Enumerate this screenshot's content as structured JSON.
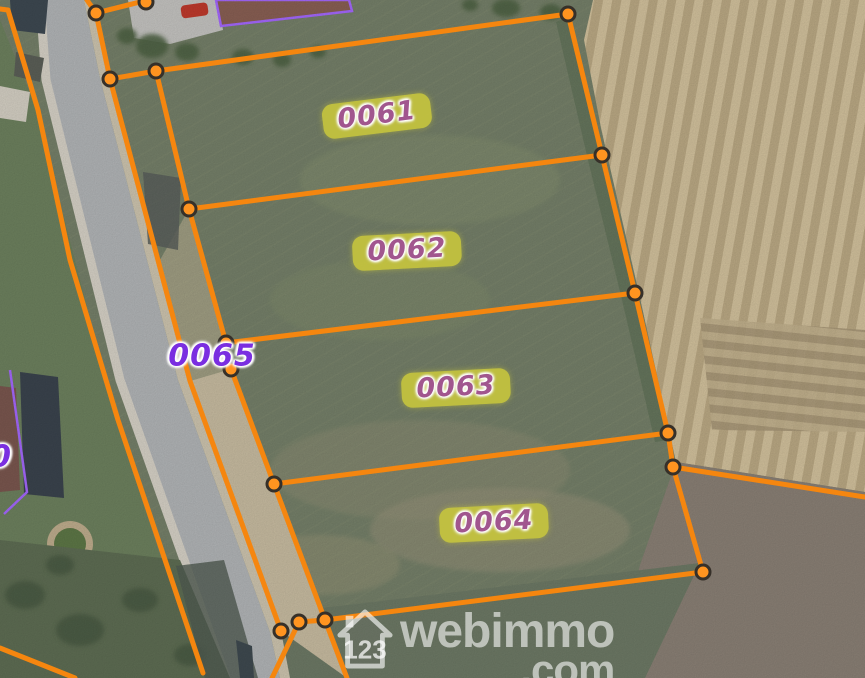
{
  "map": {
    "description": "Aerial cadastral map with orange parcel boundaries over a satellite photo",
    "watermark": {
      "icon_text": "123",
      "brand": "webimmo",
      "suffix": ".com"
    },
    "parcel_labels": {
      "badged": [
        {
          "id": "0061",
          "x": 377,
          "y": 116,
          "rot": -7
        },
        {
          "id": "0062",
          "x": 407,
          "y": 251,
          "rot": -3
        },
        {
          "id": "0063",
          "x": 456,
          "y": 388,
          "rot": -3
        },
        {
          "id": "0064",
          "x": 494,
          "y": 523,
          "rot": -3
        }
      ],
      "plain": [
        {
          "id": "0065",
          "x": 212,
          "y": 356,
          "rot": 0
        },
        {
          "id": "0",
          "x": 1,
          "y": 457,
          "rot": 0
        }
      ]
    },
    "overlay": {
      "line_color": "#f5860f",
      "vertex_fill": "#ff9420",
      "vertex_ring": "#363029",
      "badge_bg": "#c5c43e",
      "badge_text_color": "#a1568e",
      "plain_text_color": "#7a2ee0",
      "building_outline_color": "#a568ff",
      "lines": [
        {
          "name": "north-cross-a",
          "points": [
            [
              87,
              0
            ],
            [
              96,
              13
            ]
          ]
        },
        {
          "name": "north-cross-b",
          "points": [
            [
              96,
              13
            ],
            [
              148,
              0
            ]
          ]
        },
        {
          "name": "roadside-outer",
          "points": [
            [
              96,
              13
            ],
            [
              110,
              79
            ],
            [
              190,
              381
            ],
            [
              281,
              631
            ]
          ]
        },
        {
          "name": "strip-north-edge",
          "points": [
            [
              110,
              79
            ],
            [
              156,
              71
            ]
          ]
        },
        {
          "name": "parcels-west-edge",
          "points": [
            [
              156,
              71
            ],
            [
              189,
              209
            ],
            [
              226,
              343
            ],
            [
              231,
              369
            ],
            [
              274,
              484
            ],
            [
              325,
              620
            ],
            [
              347,
              678
            ]
          ]
        },
        {
          "name": "parcels-north-edge",
          "points": [
            [
              156,
              71
            ],
            [
              568,
              14
            ]
          ]
        },
        {
          "name": "parcels-east-edge",
          "points": [
            [
              568,
              14
            ],
            [
              602,
              155
            ],
            [
              635,
              293
            ],
            [
              668,
              433
            ],
            [
              673,
              467
            ],
            [
              703,
              572
            ]
          ]
        },
        {
          "name": "div-0061-0062",
          "points": [
            [
              189,
              209
            ],
            [
              602,
              155
            ]
          ]
        },
        {
          "name": "div-0062-0063",
          "points": [
            [
              226,
              343
            ],
            [
              635,
              293
            ]
          ]
        },
        {
          "name": "div-0063-0064",
          "points": [
            [
              274,
              484
            ],
            [
              668,
              433
            ]
          ]
        },
        {
          "name": "parcels-south-edge",
          "points": [
            [
              325,
              620
            ],
            [
              703,
              572
            ]
          ]
        },
        {
          "name": "south-cluster",
          "points": [
            [
              325,
              620
            ],
            [
              299,
              622
            ],
            [
              272,
              678
            ]
          ]
        },
        {
          "name": "east-extension",
          "points": [
            [
              673,
              467
            ],
            [
              865,
              497
            ]
          ]
        },
        {
          "name": "west-of-road",
          "points": [
            [
              0,
              9
            ],
            [
              8,
              10
            ],
            [
              38,
              110
            ],
            [
              70,
              260
            ],
            [
              118,
              420
            ],
            [
              203,
              673
            ]
          ]
        },
        {
          "name": "southwest-line",
          "points": [
            [
              0,
              648
            ],
            [
              75,
              678
            ]
          ]
        }
      ],
      "vertices": [
        [
          96,
          13
        ],
        [
          146,
          2
        ],
        [
          110,
          79
        ],
        [
          156,
          71
        ],
        [
          189,
          209
        ],
        [
          226,
          343
        ],
        [
          231,
          369
        ],
        [
          274,
          484
        ],
        [
          281,
          631
        ],
        [
          299,
          622
        ],
        [
          325,
          620
        ],
        [
          568,
          14
        ],
        [
          602,
          155
        ],
        [
          635,
          293
        ],
        [
          668,
          433
        ],
        [
          673,
          467
        ],
        [
          703,
          572
        ]
      ]
    }
  }
}
